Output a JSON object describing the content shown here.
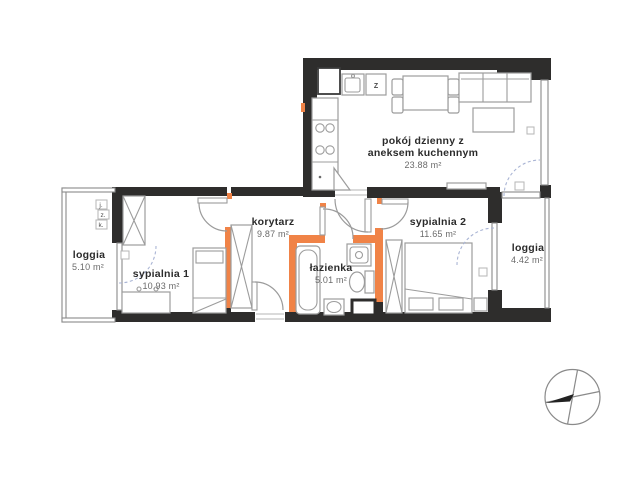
{
  "plan_title": "apartment floor plan",
  "rooms": {
    "living": {
      "name_line1": "pokój dzienny z",
      "name_line2": "aneksem kuchennym",
      "area": "23.88 m²"
    },
    "hallway": {
      "name": "korytarz",
      "area": "9.87 m²"
    },
    "bedroom1": {
      "name": "sypialnia 1",
      "area": "10.93 m²"
    },
    "bedroom2": {
      "name": "sypialnia 2",
      "area": "11.65 m²"
    },
    "bathroom": {
      "name": "łazienka",
      "area": "5.01 m²"
    },
    "loggia_left": {
      "name": "loggia",
      "area": "5.10 m²"
    },
    "loggia_right": {
      "name": "loggia",
      "area": "4.42 m²"
    }
  },
  "kitchen": {
    "dishwasher_label": "Z"
  },
  "legend": {
    "items": [
      "j.",
      "z.",
      "k."
    ]
  },
  "colors": {
    "wall": "#2e2d2c",
    "accent": "#f08347",
    "furniture_line": "#9c9c9c",
    "door_swing_dashed": "#a9b4d4",
    "room_name_text": "#2b2b2b",
    "room_area_text": "#6b6b6b"
  }
}
